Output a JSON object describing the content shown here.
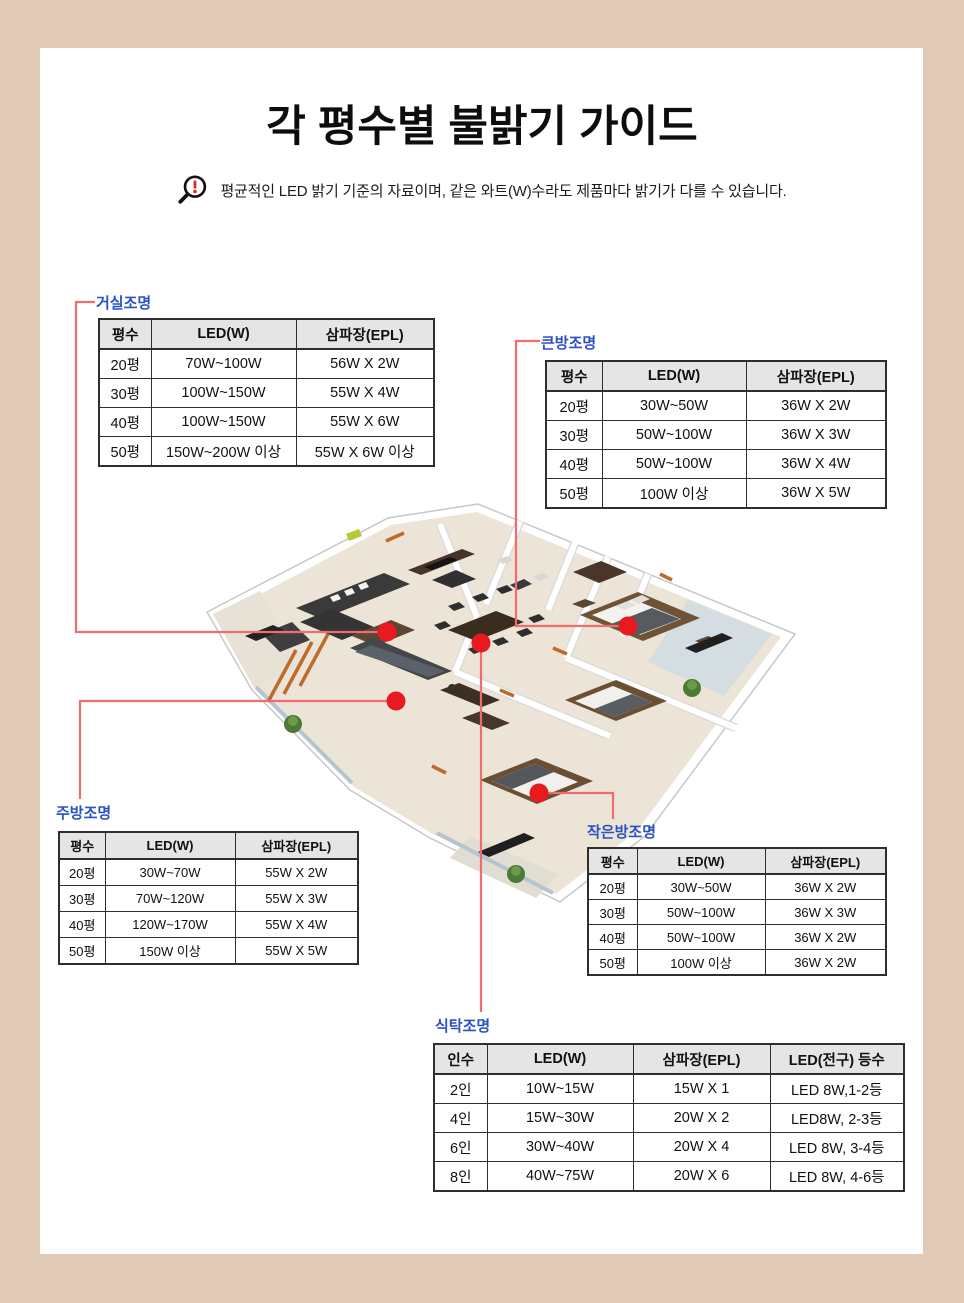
{
  "page": {
    "title": "각 평수별 불밝기 가이드",
    "notice": "평균적인 LED 밝기 기준의 자료이며, 같은 와트(W)수라도 제품마다 밝기가 다를 수 있습니다.",
    "notice_icon": "magnifier-warning-icon",
    "floorplan_icon": "apartment-floorplan-illustration"
  },
  "colors": {
    "frame_background": "#e0cab6",
    "panel_background": "#ffffff",
    "section_label_text": "#2a52c5",
    "connector_line": "#f16c6c",
    "marker_dot": "#e8191f",
    "table_header_background": "#e5e5e5",
    "table_border": "#2e2e2e"
  },
  "sections": {
    "living": {
      "label": "거실조명",
      "marker_icon": "living-room-light-dot",
      "headers": [
        "평수",
        "LED(W)",
        "삼파장(EPL)"
      ],
      "rows": [
        [
          "20평",
          "70W~100W",
          "56W X 2W"
        ],
        [
          "30평",
          "100W~150W",
          "55W X 4W"
        ],
        [
          "40평",
          "100W~150W",
          "55W X 6W"
        ],
        [
          "50평",
          "150W~200W 이상",
          "55W X 6W 이상"
        ]
      ]
    },
    "master": {
      "label": "큰방조명",
      "marker_icon": "master-room-light-dot",
      "headers": [
        "평수",
        "LED(W)",
        "삼파장(EPL)"
      ],
      "rows": [
        [
          "20평",
          "30W~50W",
          "36W X 2W"
        ],
        [
          "30평",
          "50W~100W",
          "36W X 3W"
        ],
        [
          "40평",
          "50W~100W",
          "36W X 4W"
        ],
        [
          "50평",
          "100W 이상",
          "36W X 5W"
        ]
      ]
    },
    "kitchen": {
      "label": "주방조명",
      "marker_icon": "kitchen-light-dot",
      "headers": [
        "평수",
        "LED(W)",
        "삼파장(EPL)"
      ],
      "rows": [
        [
          "20평",
          "30W~70W",
          "55W X 2W"
        ],
        [
          "30평",
          "70W~120W",
          "55W X 3W"
        ],
        [
          "40평",
          "120W~170W",
          "55W X 4W"
        ],
        [
          "50평",
          "150W 이상",
          "55W X 5W"
        ]
      ]
    },
    "small": {
      "label": "작은방조명",
      "marker_icon": "small-room-light-dot",
      "headers": [
        "평수",
        "LED(W)",
        "삼파장(EPL)"
      ],
      "rows": [
        [
          "20평",
          "30W~50W",
          "36W X 2W"
        ],
        [
          "30평",
          "50W~100W",
          "36W X 3W"
        ],
        [
          "40평",
          "50W~100W",
          "36W X 2W"
        ],
        [
          "50평",
          "100W 이상",
          "36W X 2W"
        ]
      ]
    },
    "dining": {
      "label": "식탁조명",
      "marker_icon": "dining-table-light-dot",
      "headers": [
        "인수",
        "LED(W)",
        "삼파장(EPL)",
        "LED(전구) 등수"
      ],
      "rows": [
        [
          "2인",
          "10W~15W",
          "15W X 1",
          "LED 8W,1-2등"
        ],
        [
          "4인",
          "15W~30W",
          "20W X 2",
          "LED8W, 2-3등"
        ],
        [
          "6인",
          "30W~40W",
          "20W X 4",
          "LED 8W, 3-4등"
        ],
        [
          "8인",
          "40W~75W",
          "20W X 6",
          "LED 8W, 4-6등"
        ]
      ]
    }
  }
}
